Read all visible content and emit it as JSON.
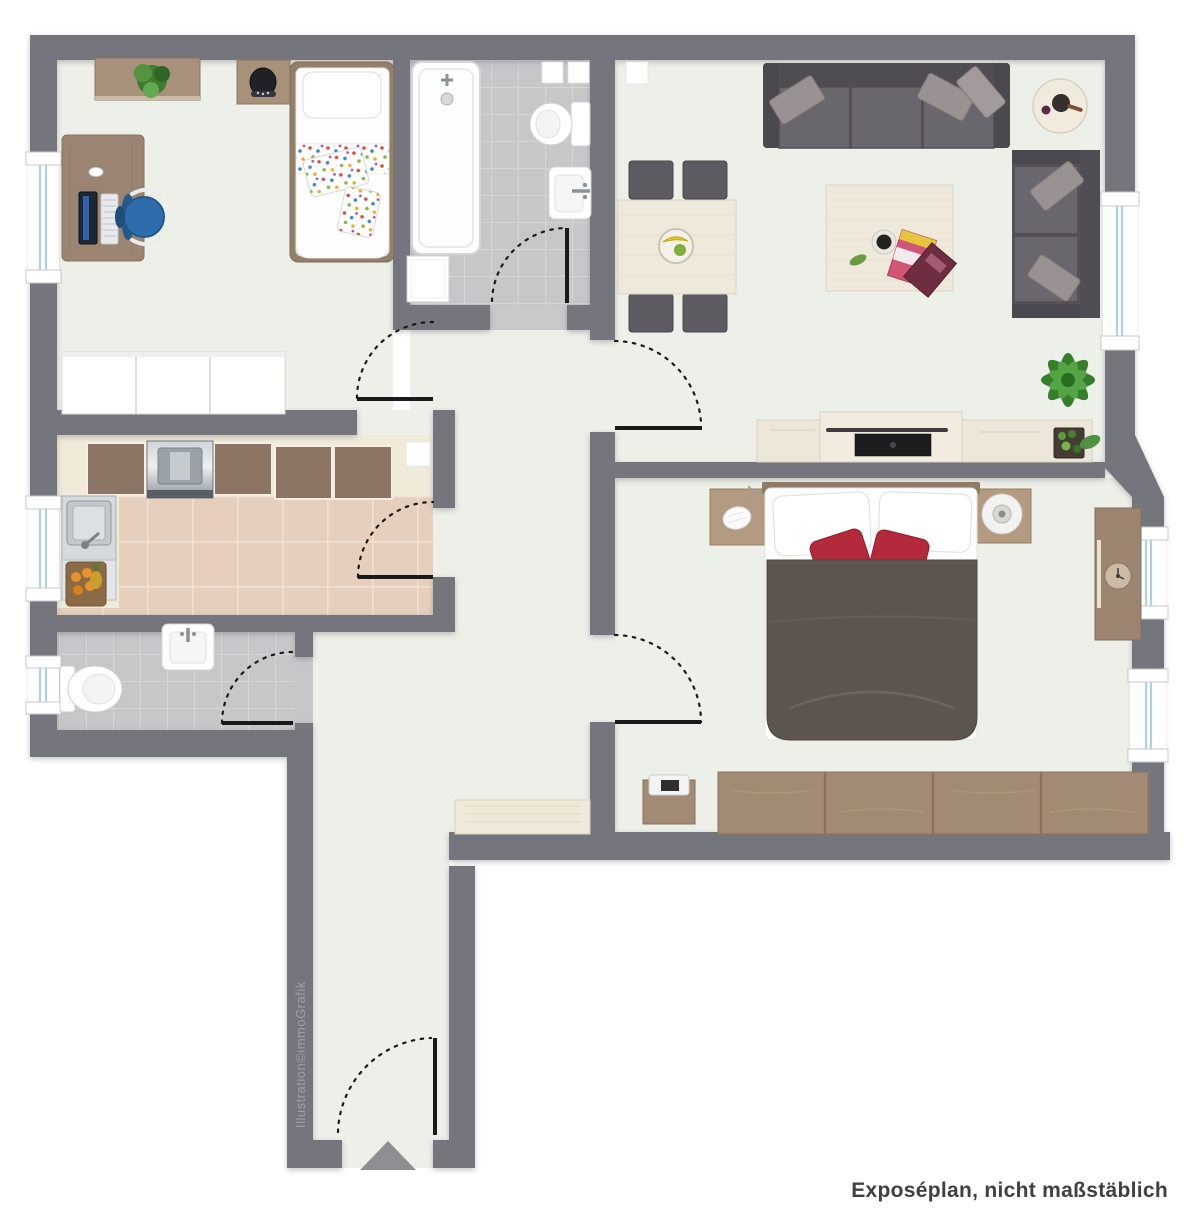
{
  "texts": {
    "credit": "Illustration©immoGrafik",
    "disclaimer": "Exposéplan, nicht maßstäblich"
  },
  "colors": {
    "background": "#ffffff",
    "wall": "#75757d",
    "floor": "#edf0e9",
    "kitchen_tile": "#e6cfbc",
    "kitchen_grout": "#f2e2d6",
    "bath_tile": "#c7c7ca",
    "bath_grout": "#d6d6d9",
    "counter_cream": "#f0ead9",
    "wood": "#9b8571",
    "wood_dark": "#8d7566",
    "cream_furniture": "#eee9db",
    "sofa": "#57535a",
    "sofa_seat": "#6a666d",
    "pillow_gray": "#9a9192",
    "bed_duvet": "#5c544e",
    "accent_red": "#b22a3c",
    "chair_blue": "#2f6fae",
    "plant_green": "#4a8f3c",
    "window_glass": "#aed3de",
    "door_line": "#1a1a1a",
    "entrance_arrow": "#8f8f93",
    "text_dark": "#3f4040",
    "text_light": "#9fa0a6"
  },
  "floorplan": {
    "type": "apartment-top-view",
    "rooms": [
      {
        "name": "children-room",
        "furniture": [
          "wall-shelf",
          "plant",
          "nightstand",
          "single-bed",
          "desk",
          "monitor",
          "keyboard",
          "office-chair",
          "wardrobe",
          "window"
        ]
      },
      {
        "name": "bathroom",
        "furniture": [
          "bathtub",
          "shower-fixture",
          "washing-machine",
          "toilet",
          "sink",
          "wall-niche"
        ]
      },
      {
        "name": "living-room",
        "furniture": [
          "large-sofa",
          "throw-pillows",
          "round-side-table",
          "corner-sofa",
          "dining-table",
          "four-chairs",
          "fruit-bowl",
          "coffee-table",
          "magazines",
          "tv-sideboard",
          "tv",
          "soundbar",
          "potted-plant",
          "window"
        ]
      },
      {
        "name": "bedroom",
        "furniture": [
          "double-bed",
          "red-pillows",
          "nightstand-lamp",
          "nightstand-tray",
          "wardrobe",
          "shoe-cabinet",
          "wall-cabinet",
          "clock",
          "two-windows"
        ]
      },
      {
        "name": "kitchen",
        "furniture": [
          "counter-row",
          "stove",
          "sink-unit",
          "fruit-basket",
          "window",
          "wall-niche"
        ]
      },
      {
        "name": "wc",
        "furniture": [
          "toilet",
          "sink",
          "window"
        ]
      },
      {
        "name": "hallway",
        "furniture": [
          "sideboard",
          "entrance-door",
          "entrance-arrow"
        ]
      }
    ],
    "doors": [
      "children-room-door",
      "bathroom-door",
      "kitchen-door",
      "wc-door",
      "living-room-door",
      "bedroom-door",
      "entrance-door"
    ]
  }
}
